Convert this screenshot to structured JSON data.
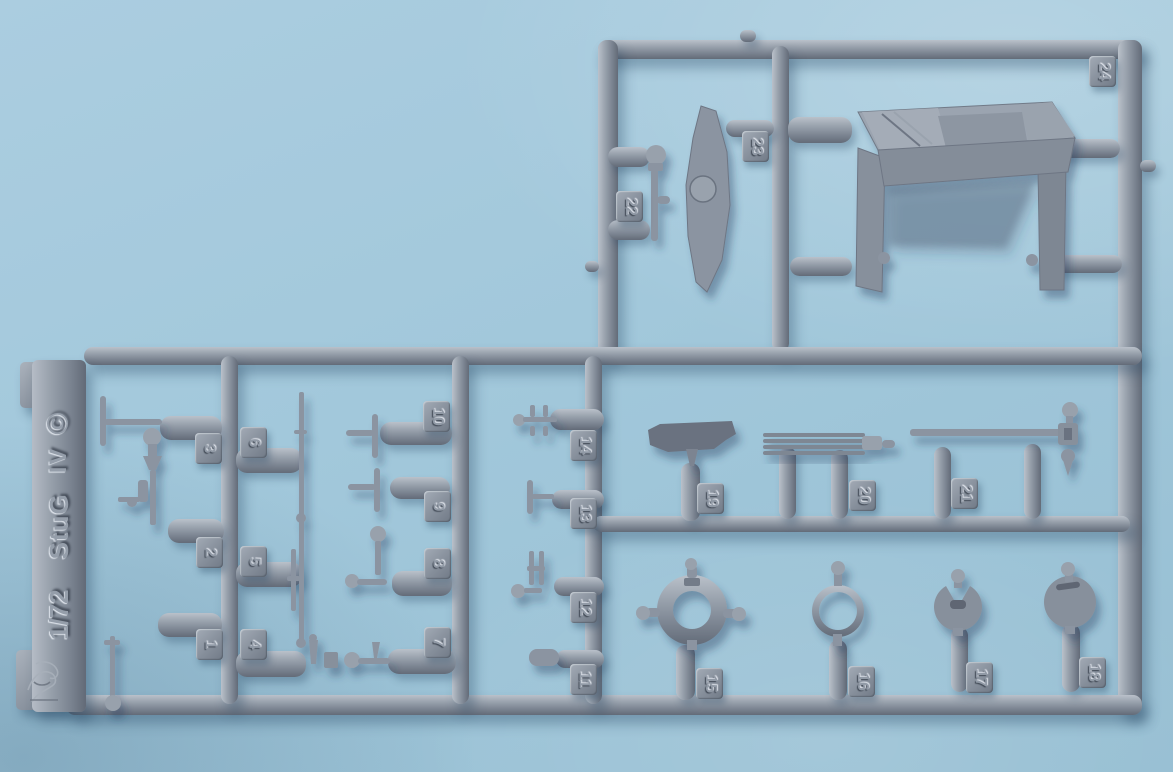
{
  "sprue_label": {
    "scale": "1/72",
    "name": "StuG",
    "variant": "IV",
    "copyright": "©"
  },
  "parts": [
    "1",
    "2",
    "3",
    "4",
    "5",
    "6",
    "7",
    "8",
    "9",
    "10",
    "11",
    "12",
    "13",
    "14",
    "15",
    "16",
    "17",
    "18",
    "19",
    "20",
    "21",
    "22",
    "23",
    "24"
  ],
  "colors": {
    "background": "#a4c9dc",
    "plastic": "#8b94a1",
    "plastic_highlight": "#bac1ca",
    "plastic_shadow": "#646c79",
    "dark_part": "#6a7280",
    "cast_shadow": "#23415f"
  }
}
